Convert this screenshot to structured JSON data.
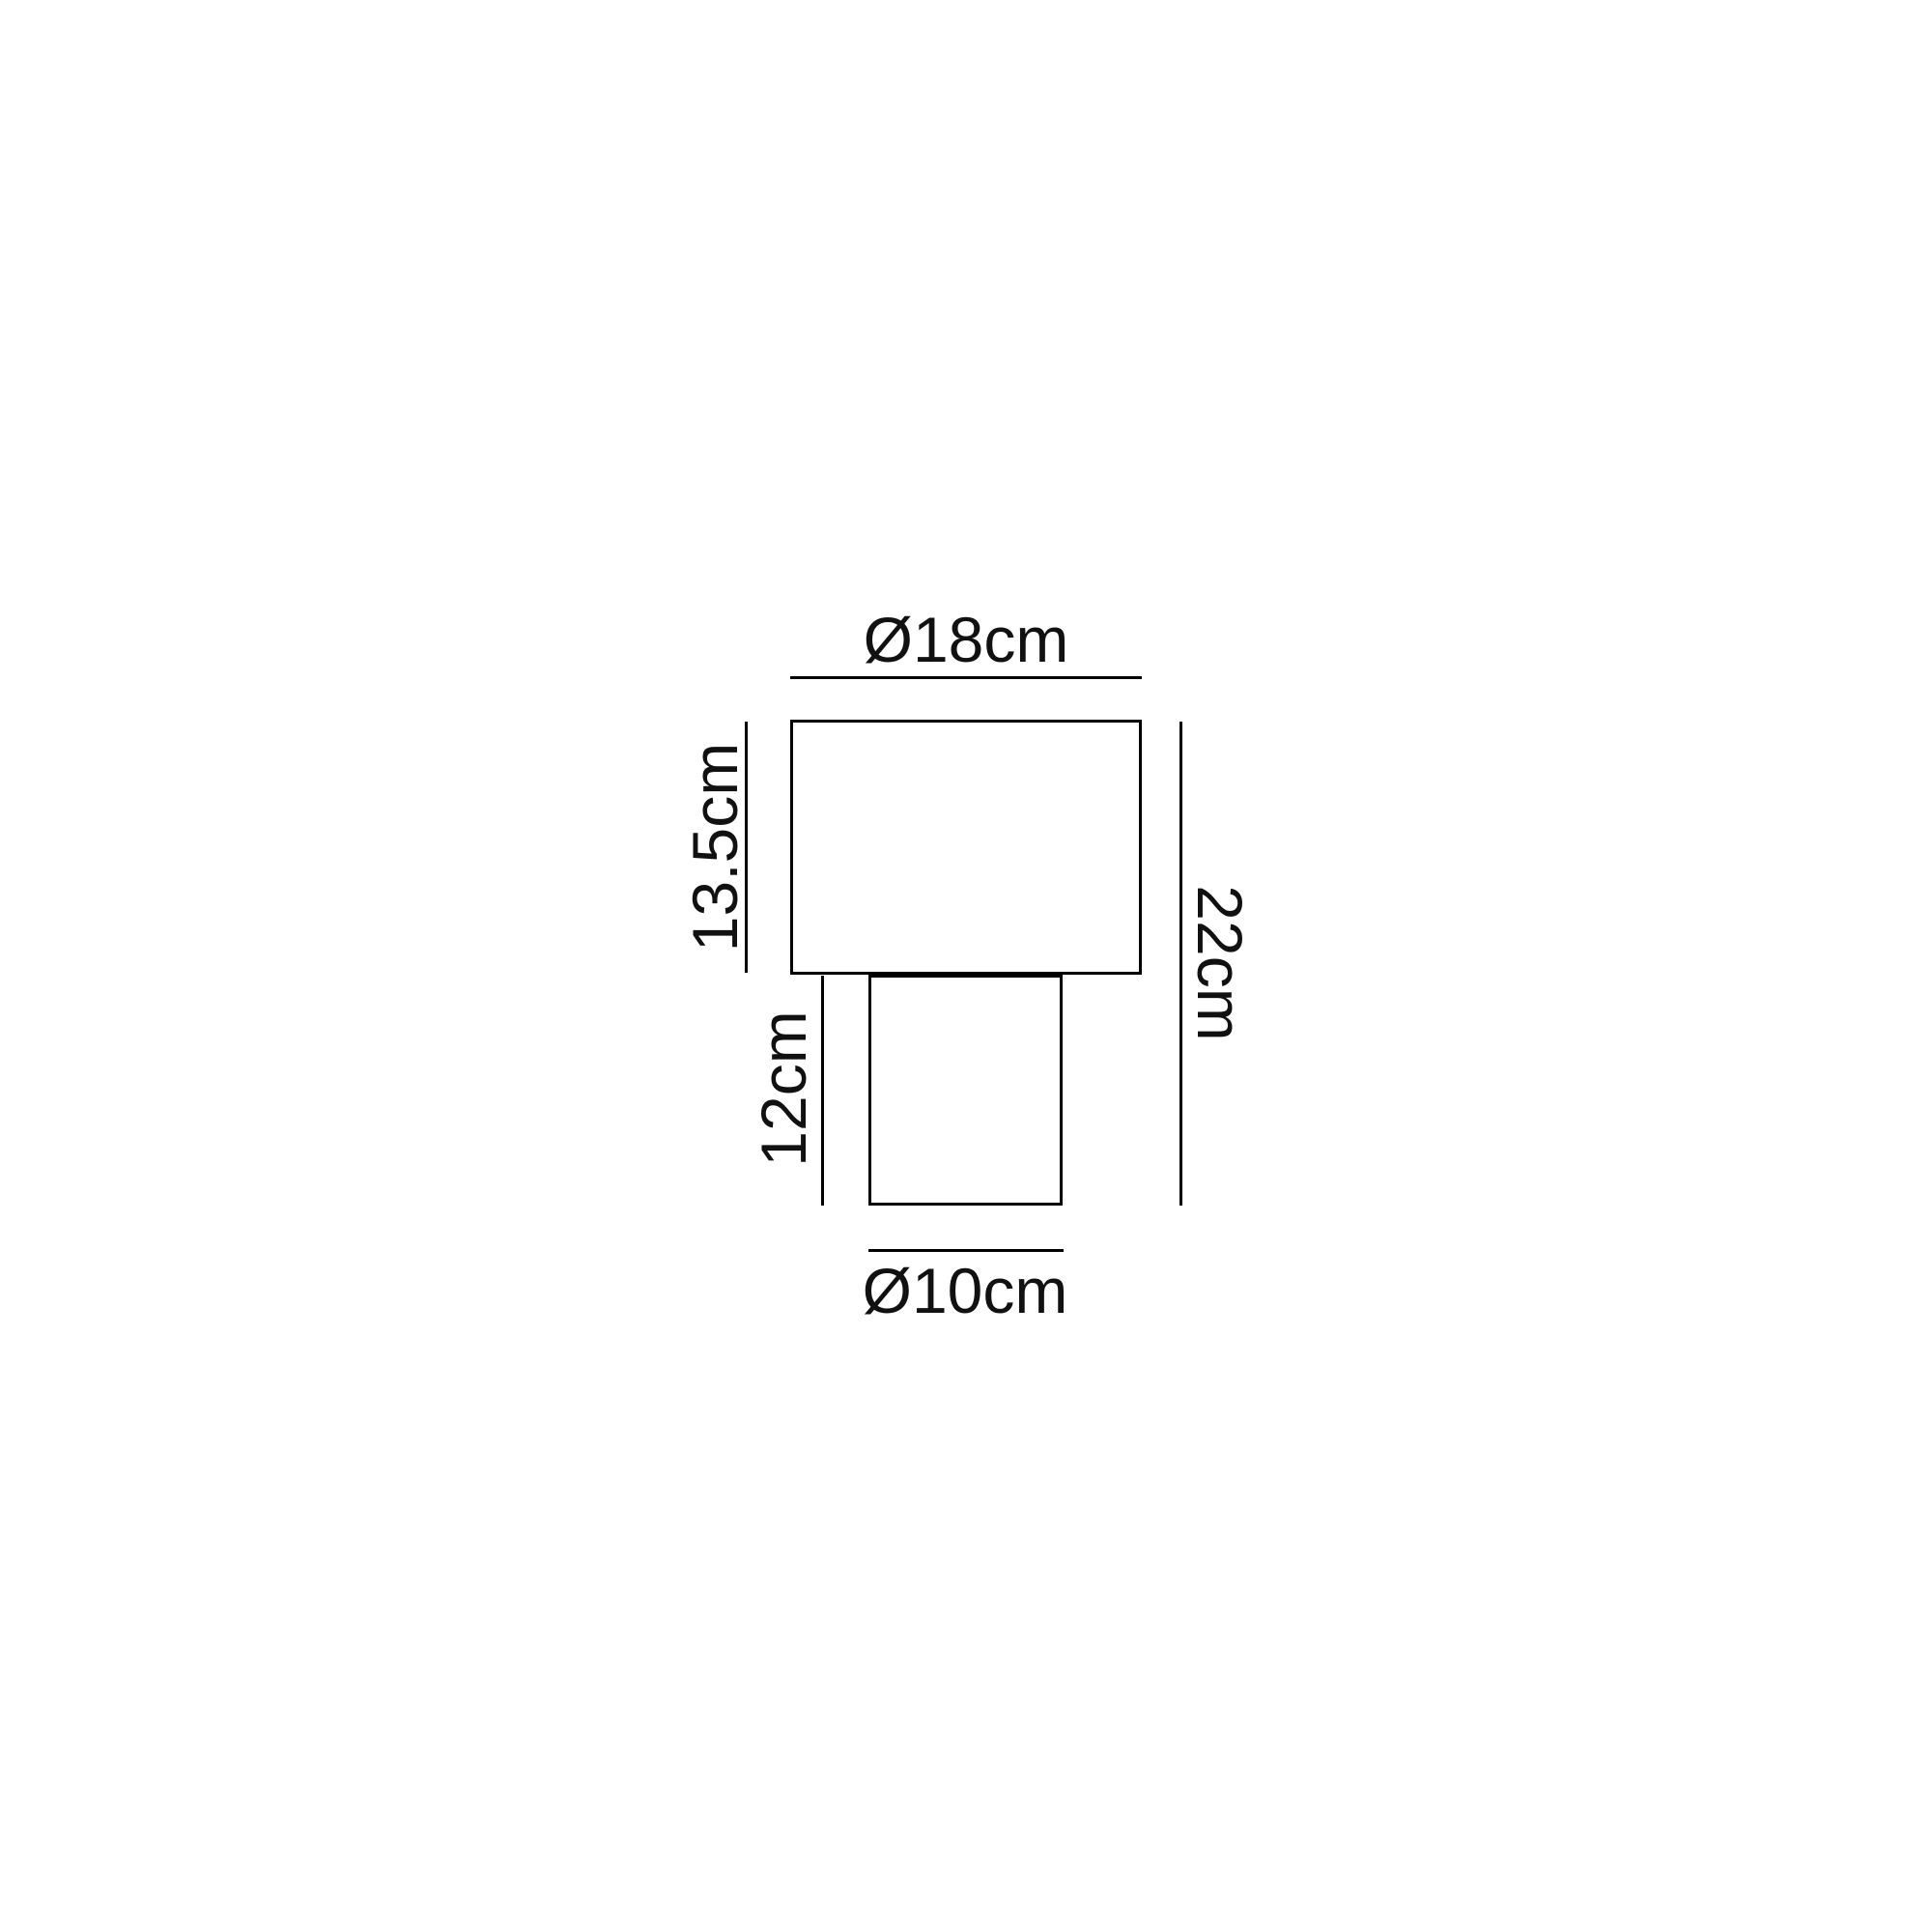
{
  "diagram": {
    "kind": "product-dimension-drawing",
    "labels": {
      "shade_diameter": "Ø18cm",
      "shade_height": "13.5cm",
      "base_height": "12cm",
      "total_height": "22cm",
      "base_diameter": "Ø10cm"
    },
    "colors": {
      "background": "#ffffff",
      "line": "#000000",
      "text": "#111111"
    }
  }
}
